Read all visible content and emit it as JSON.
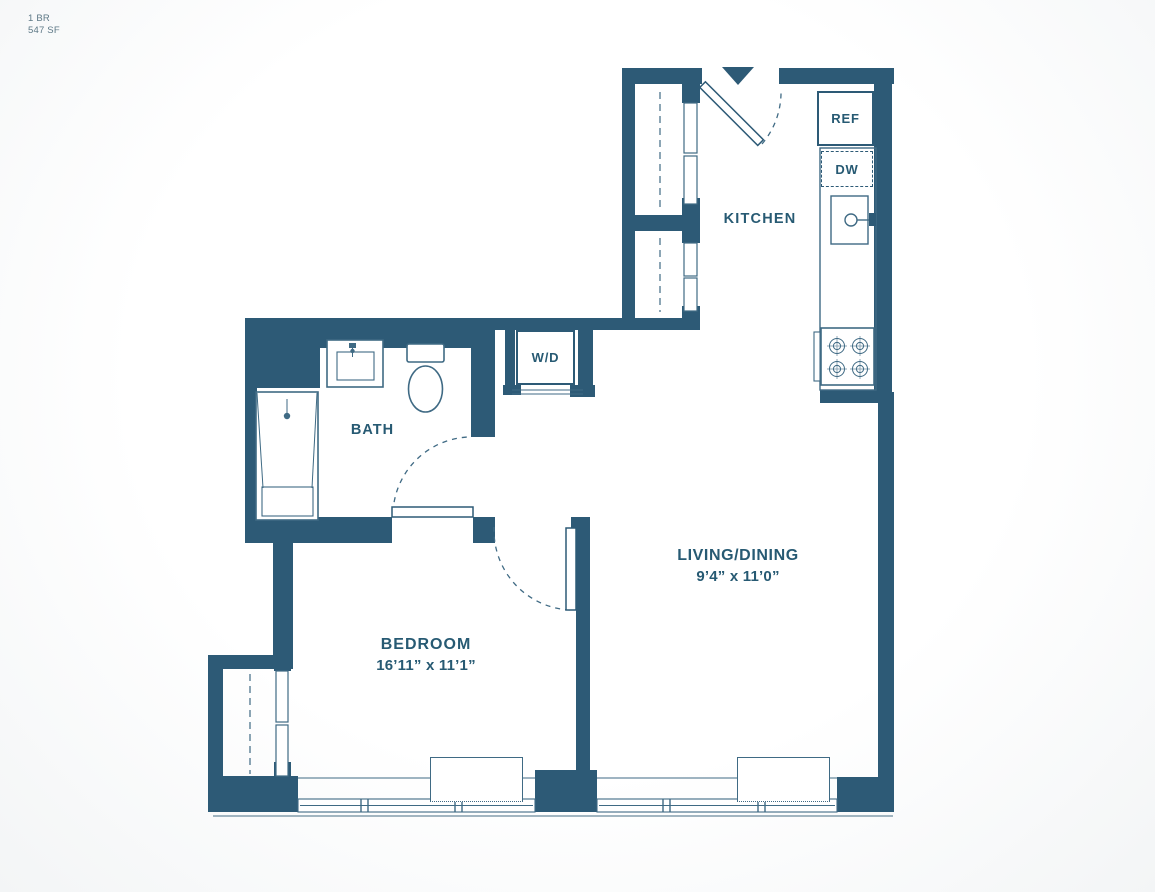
{
  "plan": {
    "unit_type": "1 BR",
    "area": "547 SF"
  },
  "rooms": {
    "kitchen": {
      "label": "KITCHEN"
    },
    "bath": {
      "label": "BATH"
    },
    "bedroom": {
      "label": "BEDROOM",
      "dimensions": "16’11” x 11’1”"
    },
    "living_dining": {
      "label": "LIVING/DINING",
      "dimensions": "9’4” x 11’0”"
    }
  },
  "appliances": {
    "refrigerator": "REF",
    "dishwasher": "DW",
    "washer_dryer": "W/D"
  },
  "fixtures": {
    "entry_marker": "entry-arrow",
    "shower": "shower-stall",
    "toilet": "toilet",
    "vanity": "vanity-sink",
    "kitchen_sink": "kitchen-sink",
    "stove": "stove-4-burner",
    "closets": "sliding-door-closets",
    "windows": "exterior-windows"
  },
  "colors": {
    "wall": "#2d5a76",
    "line": "#3f6a84",
    "text": "#275a73",
    "background": "#ffffff",
    "sill": "#6b8a9d"
  }
}
